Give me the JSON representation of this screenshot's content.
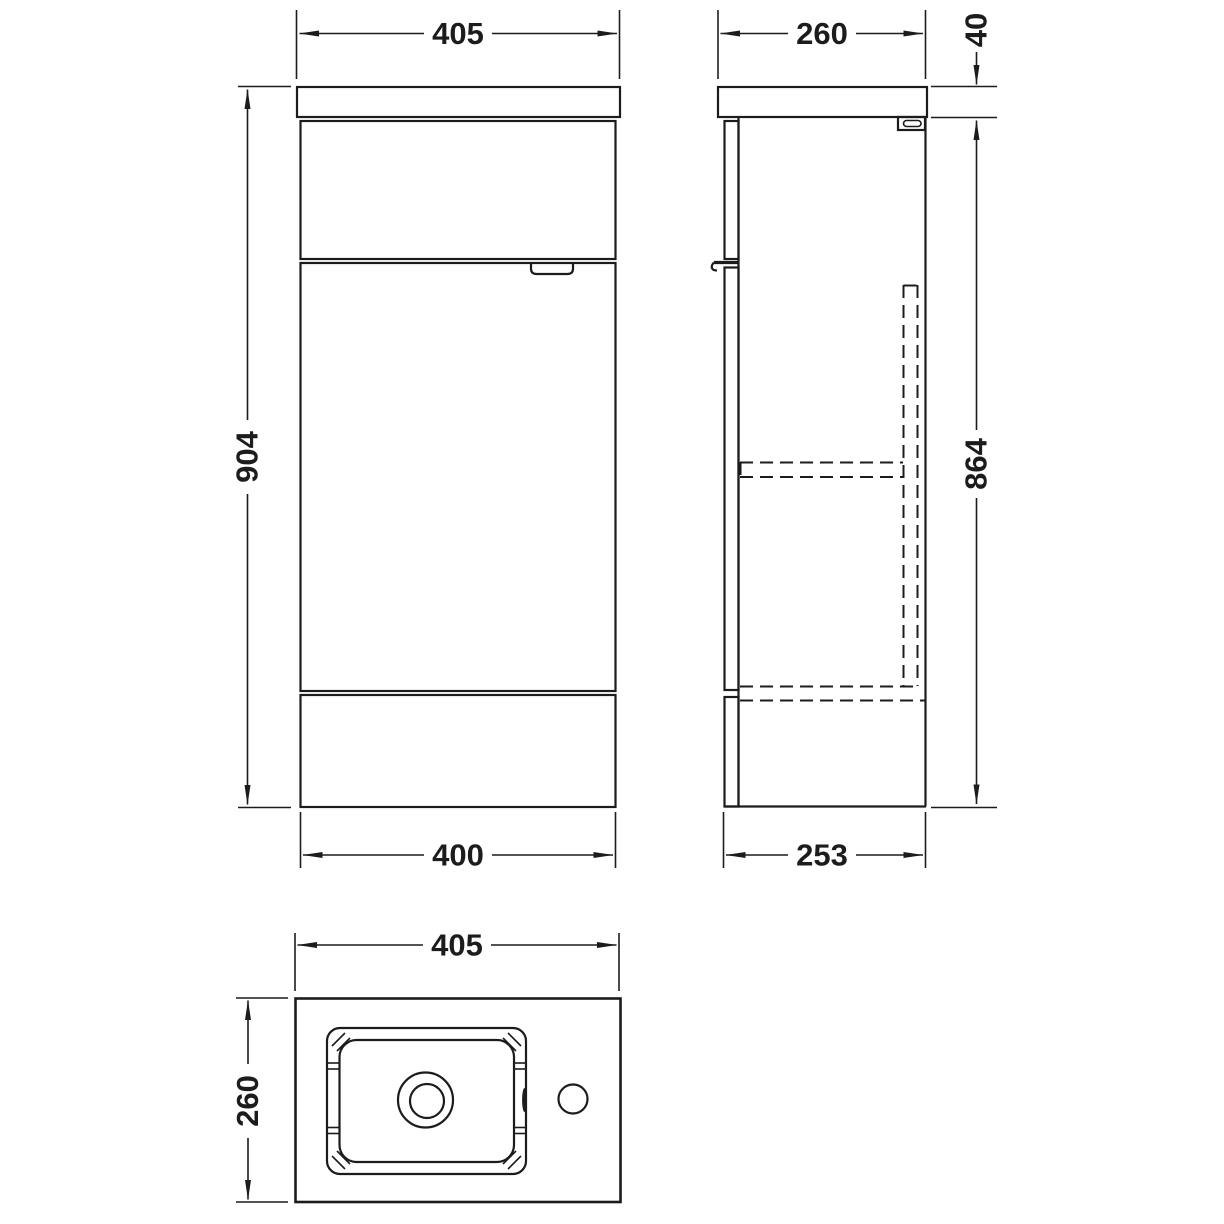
{
  "drawing": {
    "colors": {
      "line": "#1c1c1c",
      "background": "#ffffff"
    },
    "views": {
      "front": {
        "dim_width_top": "405",
        "dim_height": "904",
        "dim_width_bottom": "400"
      },
      "side": {
        "dim_depth_top": "260",
        "dim_worktop_thickness": "40",
        "dim_cabinet_height": "864",
        "dim_depth_bottom": "253"
      },
      "plan": {
        "dim_width": "405",
        "dim_depth": "260"
      }
    }
  }
}
